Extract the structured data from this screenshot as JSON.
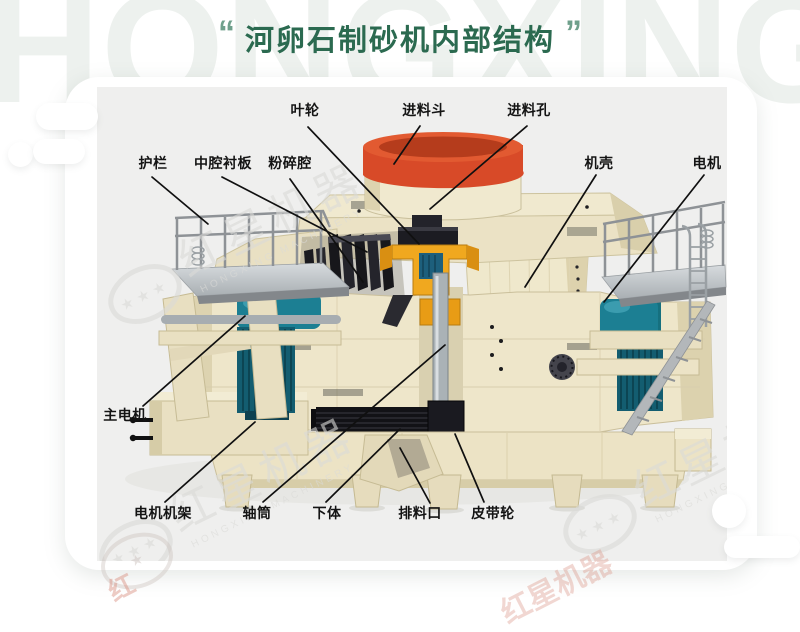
{
  "page": {
    "bg_watermark": "HONGXINGJIQI",
    "brand_cn": "红星机器",
    "brand_en": "HONGXING MACHINERY",
    "brand_fragment_left": "红",
    "brand_fragment_right": "红星机器",
    "watermark_stars": "★ ★ ★",
    "star_glyph": "★"
  },
  "title": {
    "open_quote": "“",
    "text": "河卵石制砂机内部结构",
    "close_quote": "”"
  },
  "diagram": {
    "labels": [
      {
        "id": "impeller",
        "text": "叶轮"
      },
      {
        "id": "feed-hopper",
        "text": "进料斗"
      },
      {
        "id": "feed-hole",
        "text": "进料孔"
      },
      {
        "id": "guardrail",
        "text": "护栏"
      },
      {
        "id": "cavity-liner",
        "text": "中腔衬板"
      },
      {
        "id": "crushing-chamber",
        "text": "粉碎腔"
      },
      {
        "id": "casing",
        "text": "机壳"
      },
      {
        "id": "motor",
        "text": "电机"
      },
      {
        "id": "main-motor",
        "text": "主电机"
      },
      {
        "id": "motor-frame",
        "text": "电机机架"
      },
      {
        "id": "shaft-tube",
        "text": "轴筒"
      },
      {
        "id": "lower-body",
        "text": "下体"
      },
      {
        "id": "discharge-port",
        "text": "排料口"
      },
      {
        "id": "belt-pulley",
        "text": "皮带轮"
      }
    ]
  },
  "colors": {
    "title_green": "#2b6a50",
    "accent_red": "#d84a28",
    "machine_cream": "#eee6ca",
    "motor_teal": "#1c7f93",
    "impeller_yellow": "#f0a81f",
    "diagram_bg": "#efefee",
    "watermark_gray": "#dbdbd8"
  }
}
